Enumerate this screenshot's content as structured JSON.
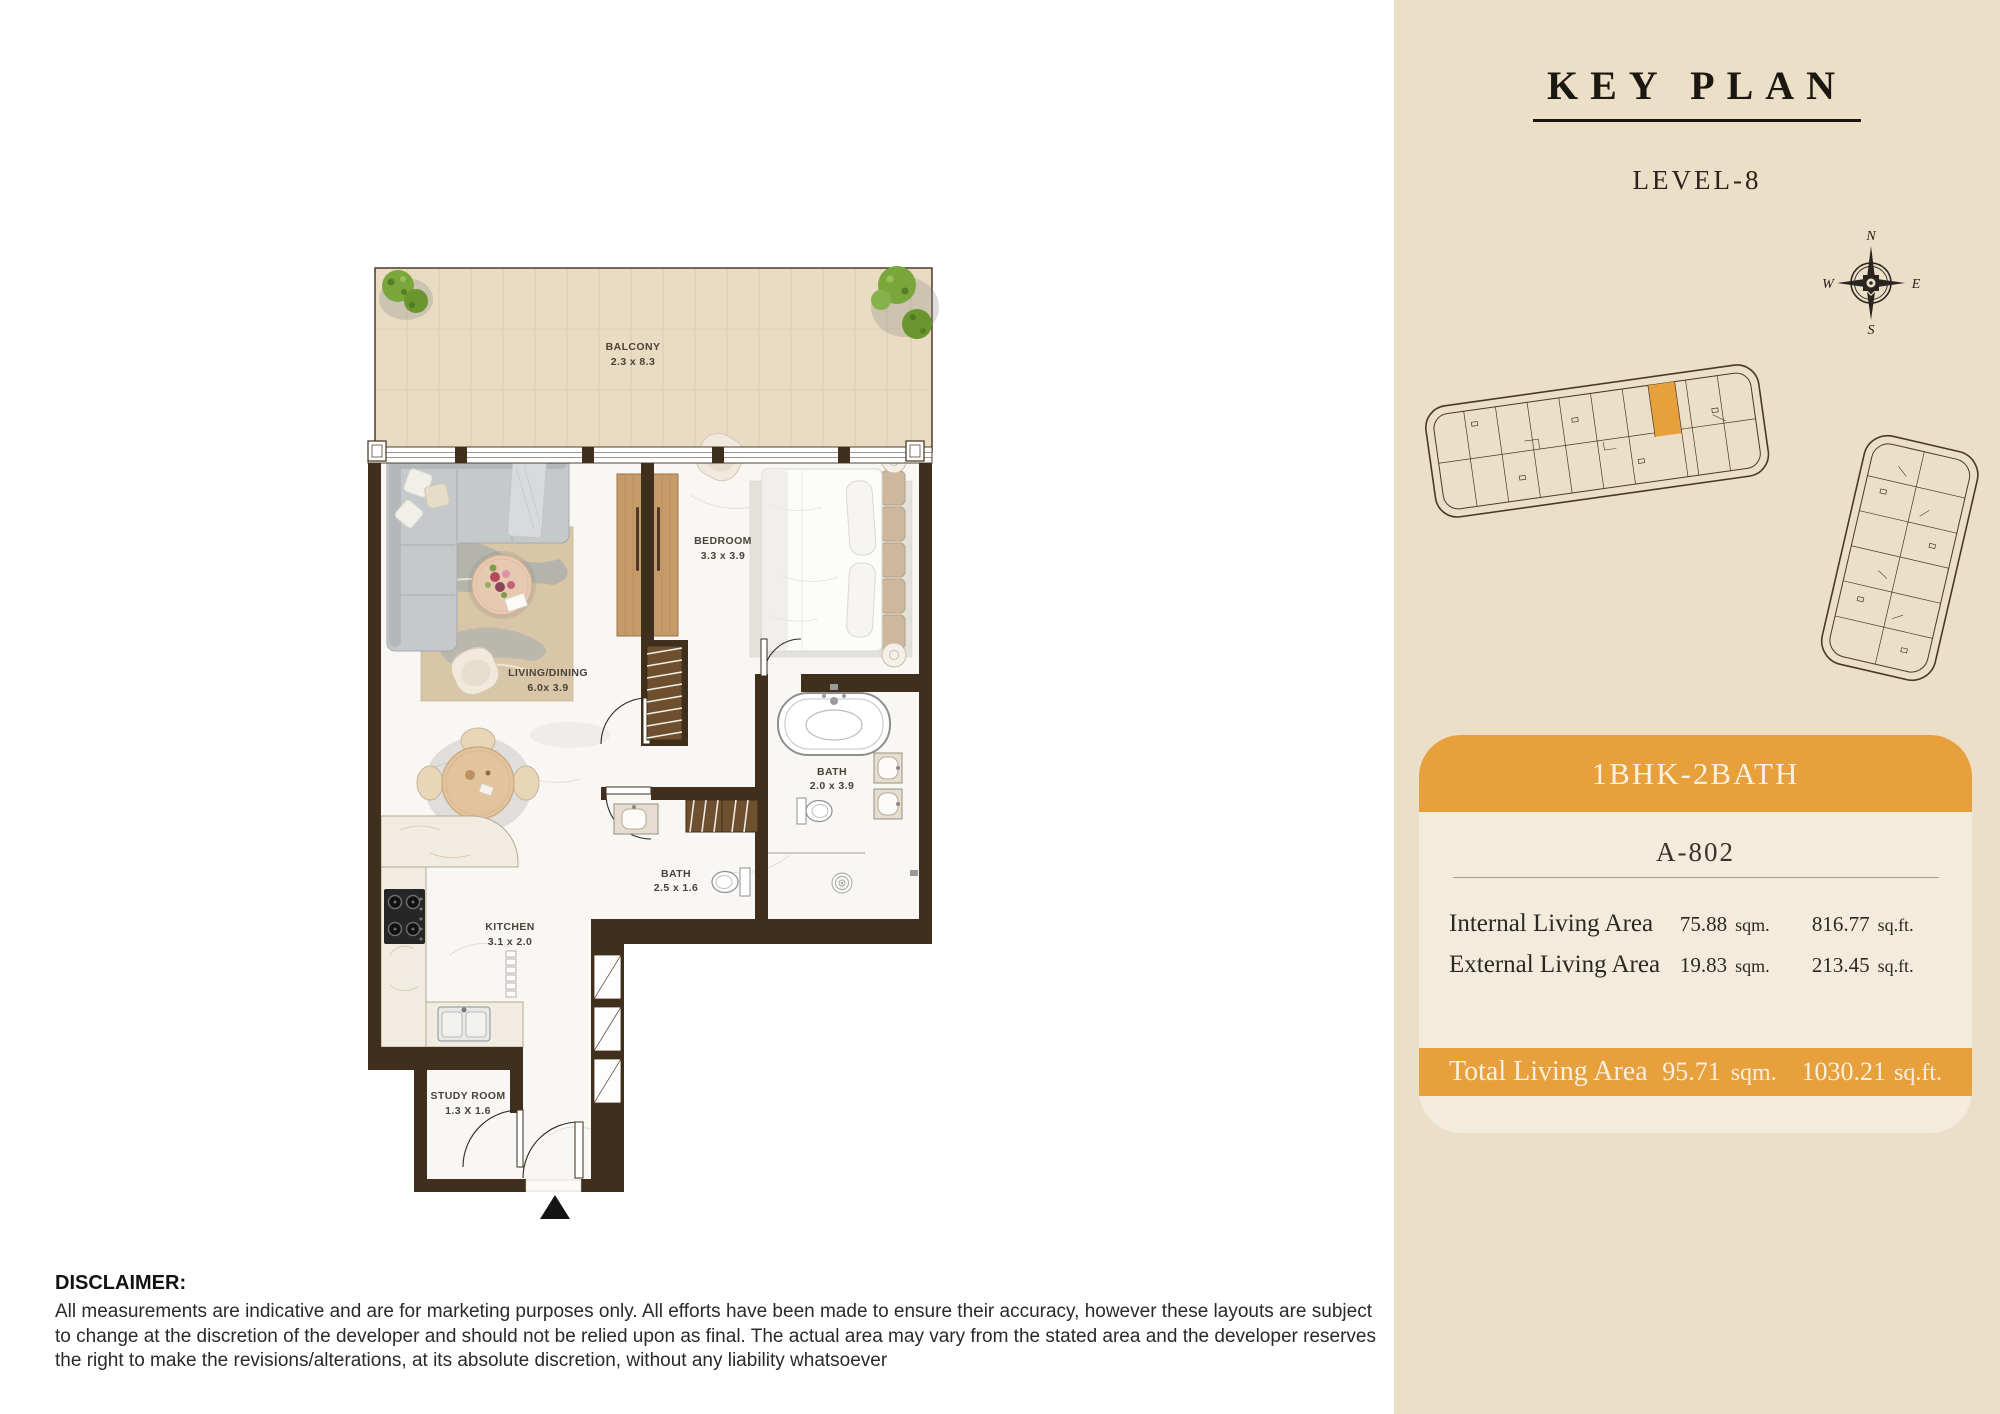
{
  "key_plan": {
    "title": "KEY PLAN",
    "level": "LEVEL-8",
    "compass": {
      "north": "N",
      "east": "E",
      "south": "S",
      "west": "W"
    }
  },
  "unit_card": {
    "type_label": "1BHK-2BATH",
    "unit_number": "A-802",
    "rows": [
      {
        "label": "Internal Living Area",
        "sqm": "75.88",
        "sqm_unit": "sqm.",
        "sqft": "816.77",
        "sqft_unit": "sq.ft."
      },
      {
        "label": "External Living Area",
        "sqm": "19.83",
        "sqm_unit": "sqm.",
        "sqft": "213.45",
        "sqft_unit": "sq.ft."
      }
    ],
    "total": {
      "label": "Total Living Area",
      "sqm": "95.71",
      "sqm_unit": "sqm.",
      "sqft": "1030.21",
      "sqft_unit": "sq.ft."
    }
  },
  "floor_plan": {
    "labels": {
      "balcony": {
        "name": "BALCONY",
        "dims": "2.3 x 8.3"
      },
      "living_dining": {
        "name": "LIVING/DINING",
        "dims": "6.0x 3.9"
      },
      "bedroom": {
        "name": "BEDROOM",
        "dims": "3.3 x 3.9"
      },
      "bath_ensuite": {
        "name": "BATH",
        "dims": "2.0 x 3.9"
      },
      "bath_guest": {
        "name": "BATH",
        "dims": "2.5 x 1.6"
      },
      "kitchen": {
        "name": "KITCHEN",
        "dims": "3.1 x 2.0"
      },
      "study": {
        "name": "STUDY ROOM",
        "dims": "1.3 X 1.6"
      }
    }
  },
  "disclaimer": {
    "heading": "DISCLAIMER:",
    "body": "All measurements are indicative and are for marketing purposes only. All efforts have been made to ensure their accuracy, however these layouts are subject to change at the discretion of the developer and should not be relied upon as final. The actual area may vary from the stated area and the developer reserves the right to make the revisions/alterations, at its absolute discretion, without any liability whatsoever"
  },
  "colors": {
    "accent_orange": "#E7A03C",
    "sidebar_bg": "#EBDFC7",
    "card_bg": "#F3EBDB",
    "wall_brown": "#3F2F1C",
    "text_dark": "#221E19",
    "bar_text": "#F8F0DE"
  }
}
